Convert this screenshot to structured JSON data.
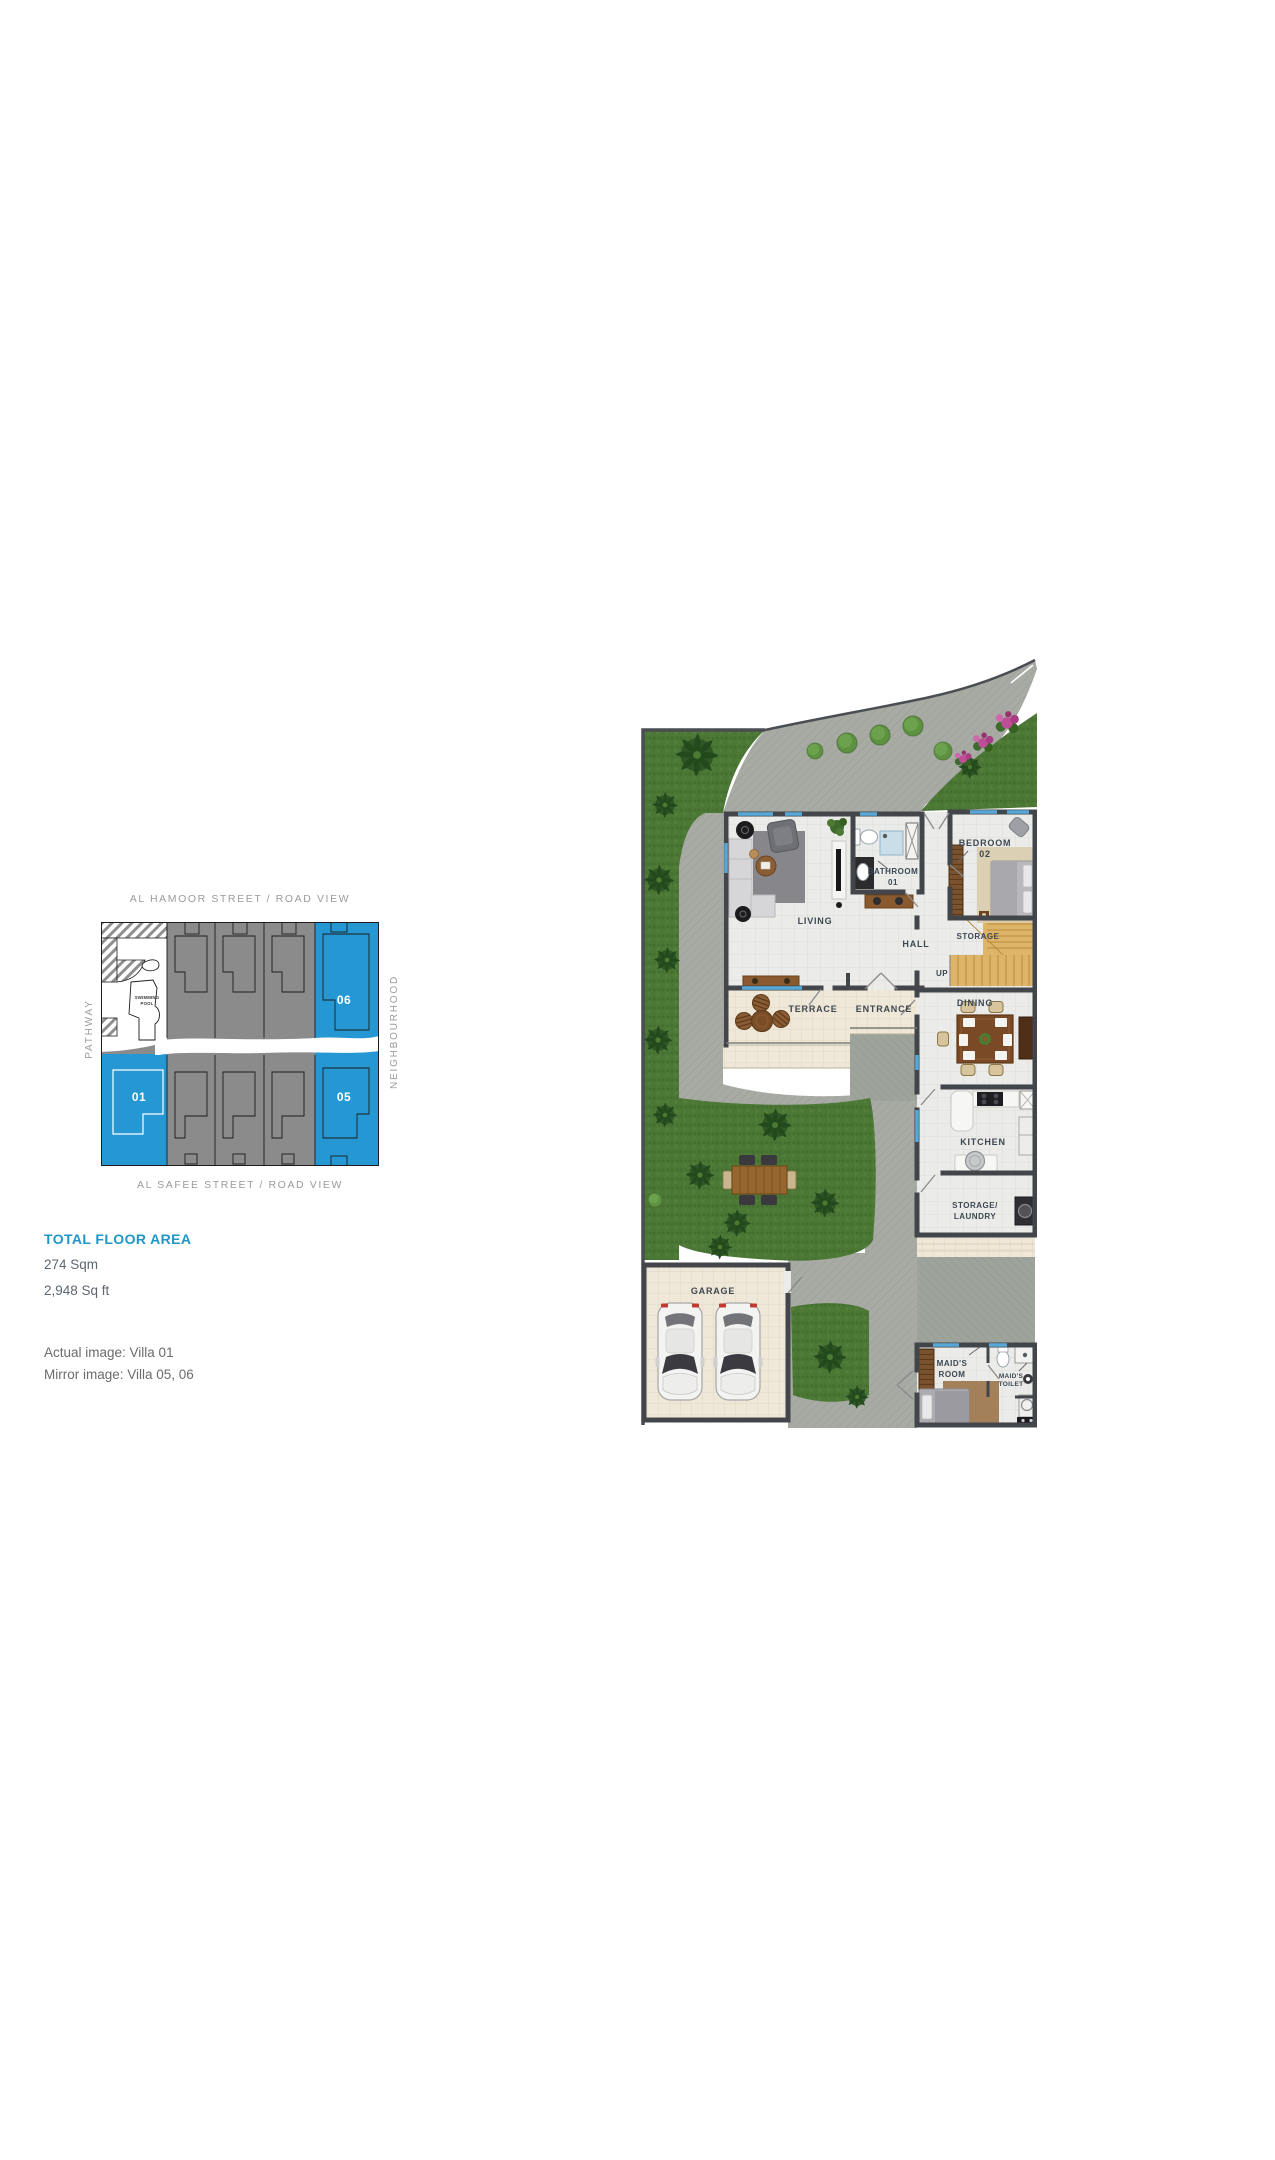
{
  "site_plan": {
    "street_top": "AL HAMOOR STREET / ROAD VIEW",
    "street_bottom": "AL SAFEE STREET / ROAD VIEW",
    "side_left": "PATHWAY",
    "side_right": "NEIGHBOURHOOD",
    "pool_line1": "SWIMMING",
    "pool_line2": "POOL",
    "villa_01": "01",
    "villa_05": "05",
    "villa_06": "06",
    "highlight_color": "#2598D4",
    "block_color": "#8B8B8B"
  },
  "summary": {
    "title": "TOTAL FLOOR AREA",
    "title_color": "#1E96C8",
    "area_sqm": "274 Sqm",
    "area_sqft": "2,948 Sq ft",
    "actual_image": "Actual image: Villa 01",
    "mirror_image": "Mirror image: Villa 05, 06"
  },
  "floor_plan": {
    "living": "LIVING",
    "bathroom_line1": "BATHROOM",
    "bathroom_line2": "01",
    "bedroom_line1": "BEDROOM",
    "bedroom_line2": "02",
    "hall": "HALL",
    "storage": "STORAGE",
    "up": "UP",
    "terrace": "TERRACE",
    "entrance": "ENTRANCE",
    "dining": "DINING",
    "kitchen": "KITCHEN",
    "storage_laundry_line1": "STORAGE/",
    "storage_laundry_line2": "LAUNDRY",
    "garage": "GARAGE",
    "maids_room_line1": "MAID'S",
    "maids_room_line2": "ROOM",
    "maids_toilet_line1": "MAID'S",
    "maids_toilet_line2": "TOILET"
  }
}
